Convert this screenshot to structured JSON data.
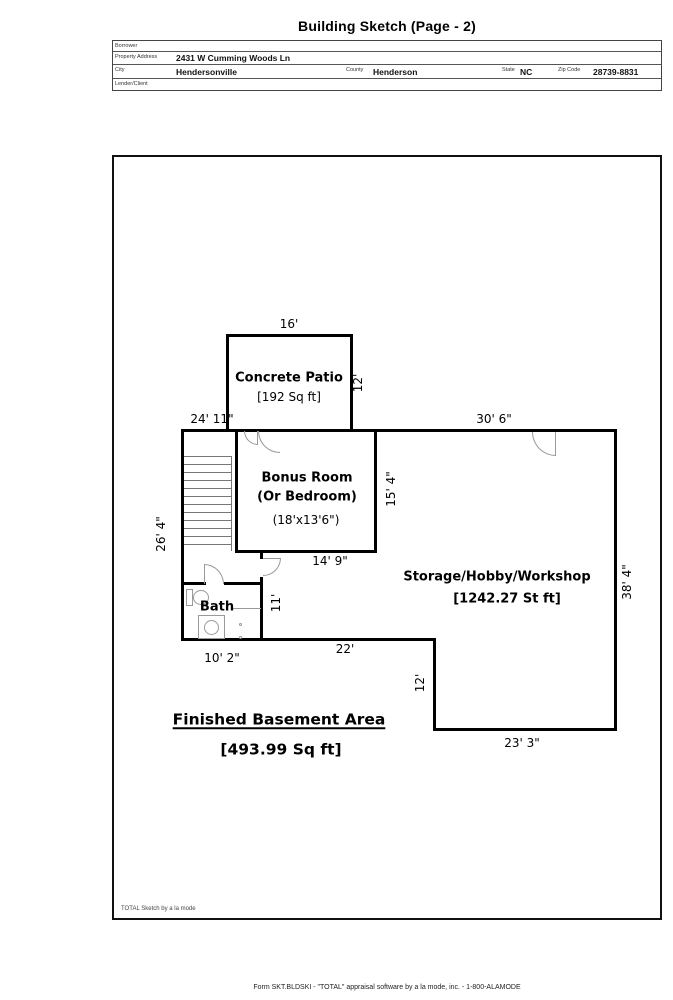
{
  "title": "Building Sketch (Page - 2)",
  "info_table": {
    "borrower_label": "Borrower",
    "borrower_value": "",
    "property_address_label": "Property Address",
    "property_address_value": "2431 W Cumming Woods Ln",
    "city_label": "City",
    "city_value": "Hendersonville",
    "county_label": "County",
    "county_value": "Henderson",
    "state_label": "State",
    "state_value": "NC",
    "zip_label": "Zip Code",
    "zip_value": "28739-8831",
    "lender_label": "Lender/Client",
    "lender_value": ""
  },
  "sketch": {
    "rooms": {
      "patio_name": "Concrete Patio",
      "patio_area": "[192 Sq ft]",
      "bonus_name": "Bonus Room",
      "bonus_name2": "(Or Bedroom)",
      "bonus_size": "(18'x13'6\")",
      "storage_name": "Storage/Hobby/Workshop",
      "storage_area": "[1242.27 St ft]",
      "bath_name": "Bath",
      "finished_name": "Finished Basement Area",
      "finished_area": "[493.99 Sq ft]"
    },
    "dimensions": {
      "patio_top": "16'",
      "patio_right": "12'",
      "top_left": "24' 11\"",
      "top_right": "30' 6\"",
      "left_side": "26' 4\"",
      "bonus_right": "15' 4\"",
      "bonus_bottom": "14' 9\"",
      "hall": "11'",
      "mid_bottom": "22'",
      "bath_bottom": "10' 2\"",
      "step_right": "12'",
      "bottom_right": "23' 3\"",
      "right_side": "38' 4\""
    },
    "watermark": "TOTAL Sketch by a la mode"
  },
  "footer_text": "Form SKT.BLDSKI - \"TOTAL\" appraisal software by a la mode, inc. - 1-800-ALAMODE",
  "colors": {
    "wall": "#000000",
    "door_arc": "#999999",
    "paper": "#ffffff"
  }
}
